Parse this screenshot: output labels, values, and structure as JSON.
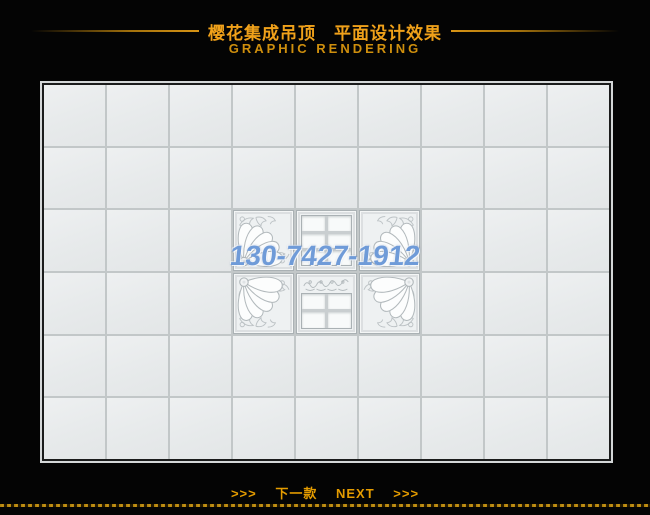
{
  "page": {
    "background": "#040404"
  },
  "header": {
    "title": "樱花集成吊顶　平面设计效果",
    "subtitle": "GRAPHIC RENDERING",
    "title_color": "#f0a11a"
  },
  "panel": {
    "grid": {
      "columns": 9,
      "rows": 6,
      "tile_color": "#e8ebec",
      "line_color": "#c2c7c8"
    },
    "feature_tiles": [
      {
        "row": 3,
        "col": 4,
        "type": "fan",
        "orient": "tl"
      },
      {
        "row": 3,
        "col": 5,
        "type": "window6"
      },
      {
        "row": 3,
        "col": 6,
        "type": "fan",
        "orient": "tr"
      },
      {
        "row": 4,
        "col": 4,
        "type": "fan",
        "orient": "bl"
      },
      {
        "row": 4,
        "col": 5,
        "type": "scrollwindow"
      },
      {
        "row": 4,
        "col": 6,
        "type": "fan",
        "orient": "br"
      }
    ]
  },
  "watermark": {
    "text": "130-7427-1912",
    "color": "#6f9bd8"
  },
  "footer": {
    "arrows_left": ">>>",
    "label_cn": "下一款",
    "label_en": "NEXT",
    "arrows_right": ">>>"
  }
}
